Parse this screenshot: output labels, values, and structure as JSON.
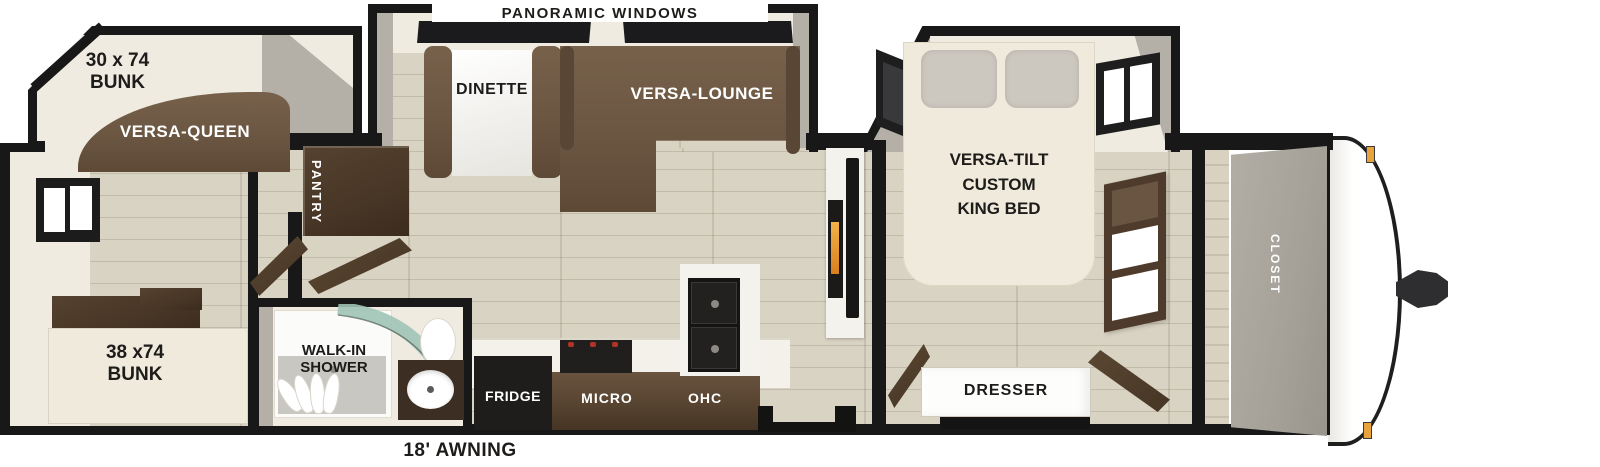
{
  "title": "Travel trailer floor plan",
  "labels": {
    "bunk_room": {
      "bunk_top_size": "30 x 74",
      "bunk_top_word": "BUNK",
      "versa_queen": "VERSA-QUEEN",
      "bunk_bottom_size": "38 x74",
      "bunk_bottom_word": "BUNK"
    },
    "living": {
      "panoramic": "PANORAMIC WINDOWS",
      "dinette": "DINETTE",
      "versa_lounge": "VERSA-LOUNGE",
      "pantry": "PANTRY"
    },
    "kitchen": {
      "fridge": "FRIDGE",
      "micro": "MICRO",
      "ohc": "OHC"
    },
    "bathroom": {
      "line1": "WALK-IN",
      "line2": "SHOWER"
    },
    "bedroom": {
      "line1": "VERSA-TILT",
      "line2": "CUSTOM",
      "line3": "KING BED",
      "dresser": "DRESSER"
    },
    "front": {
      "closet": "CLOSET"
    },
    "exterior": {
      "awning": "18' AWNING"
    }
  },
  "colors": {
    "outline": "#181818",
    "wall": "#efebe0",
    "slide_wall": "#b4b0a8",
    "floor": "#d7d0bf",
    "sofa_brown": "#6b5642",
    "cabinet_dark": "#483626",
    "appliance_black": "#1f1d1c",
    "bed_cream": "#efeadb",
    "pillow_gray": "#ccc8c0",
    "glass_teal": "#9fc4b6",
    "fireplace_orange": "#e08f2e",
    "marker_orange": "#e8a33c"
  }
}
